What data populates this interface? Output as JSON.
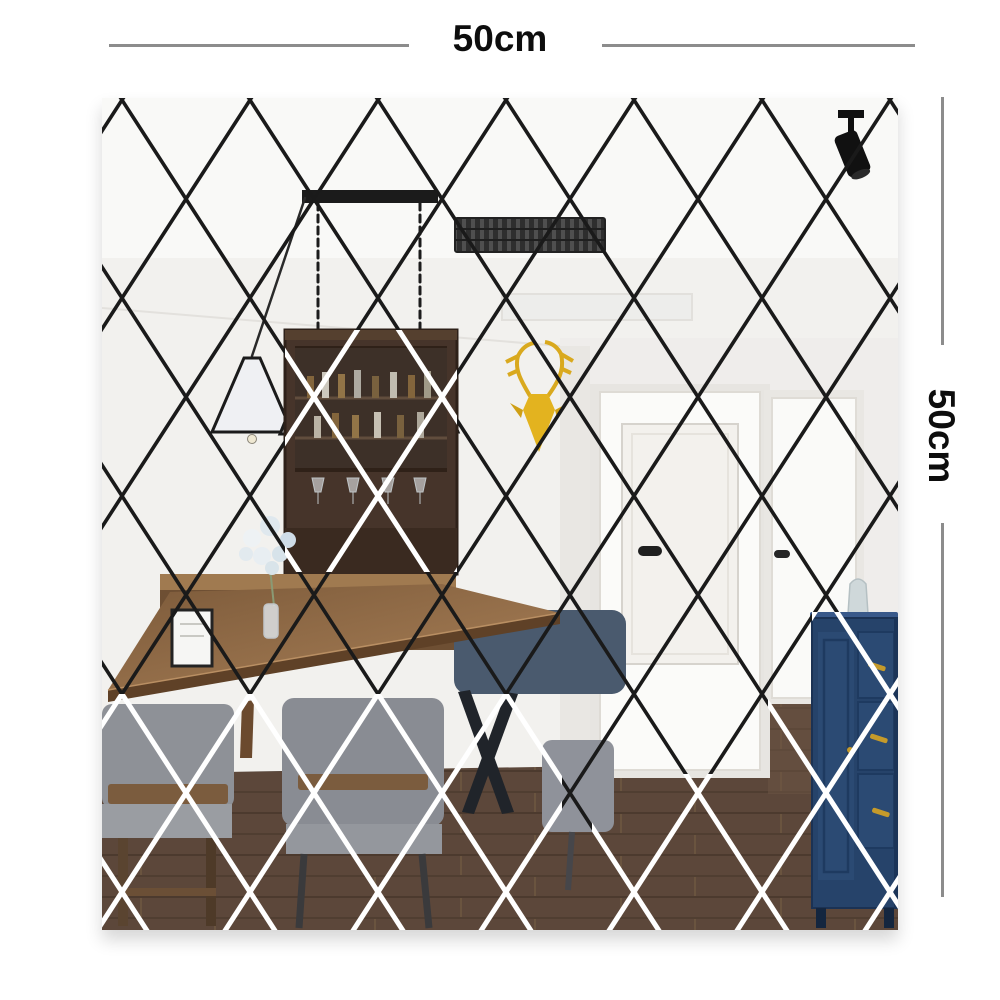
{
  "dimensions": {
    "top": {
      "label": "50cm"
    },
    "right": {
      "label": "50cm"
    },
    "line_color": "#8c8c8c",
    "label_color": "#0d0d0d"
  },
  "photo": {
    "alt": "Dining room interior reflected in a 50cm x 50cm diamond mirror tile wall sticker",
    "lattice": {
      "tile_width_px": 128,
      "tile_height_px": 198,
      "line_color_on_light": "#1a1a1a",
      "line_color_on_dark": "#ffffff"
    },
    "palette": {
      "ceiling": "#f9f9f7",
      "wall": "#f2f1ee",
      "hall_wall": "#efedeb",
      "floor": "#5c473a",
      "vent": "#2e2e2e",
      "chandelier_frame": "#1b1b1b",
      "deer_gold": "#e3b31f",
      "bar_cabinet": "#46342a",
      "counter_wood": "#6e4f33",
      "table_wood": "#8a6544",
      "chair_gray": "#8e9197",
      "chair_navy": "#4a5a6e",
      "door_white": "#fbfbf9",
      "blue_cabinet": "#26436a",
      "handle_gold": "#c59a2a",
      "spotlight_black": "#111111"
    }
  }
}
